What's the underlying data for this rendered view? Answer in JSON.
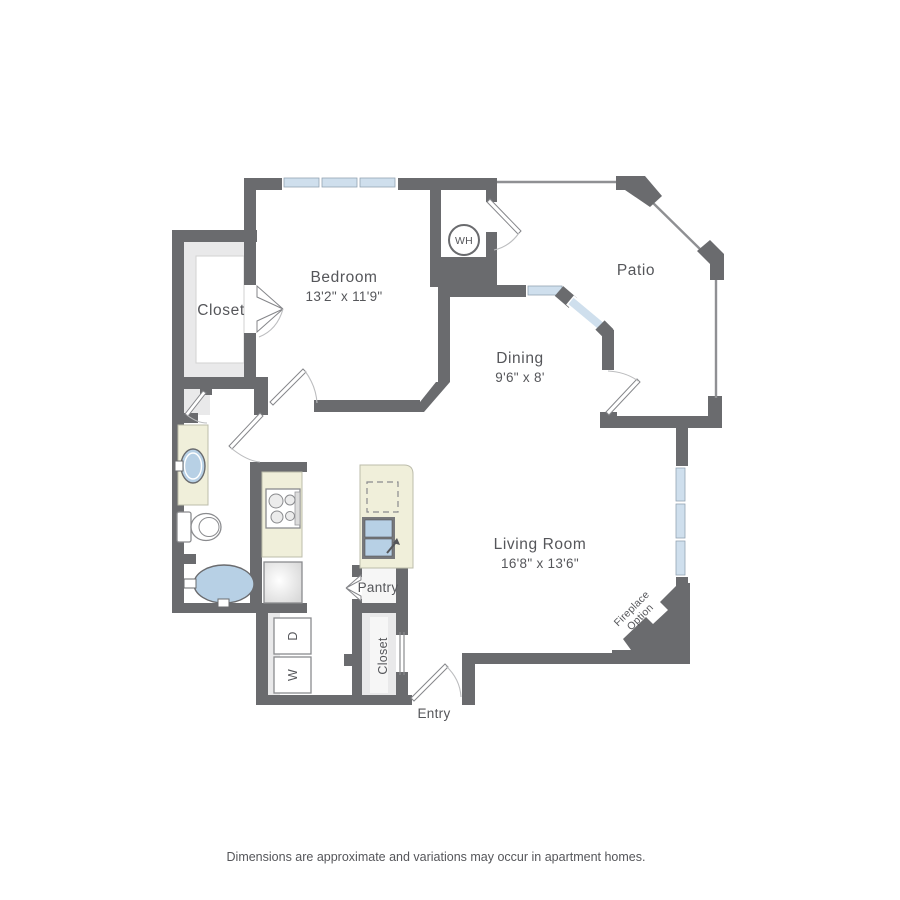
{
  "rooms": {
    "bedroom": {
      "label": "Bedroom",
      "dims": "13'2\" x 11'9\""
    },
    "bedroom_closet": {
      "label": "Closet"
    },
    "dining": {
      "label": "Dining",
      "dims": "9'6\" x 8'"
    },
    "patio": {
      "label": "Patio"
    },
    "living_room": {
      "label": "Living Room",
      "dims": "16'8\" x 13'6\""
    },
    "pantry": {
      "label": "Pantry"
    },
    "entry_closet": {
      "label": "Closet"
    },
    "entry": {
      "label": "Entry"
    },
    "water_heater": {
      "label": "WH"
    },
    "washer": {
      "label": "W"
    },
    "dryer": {
      "label": "D"
    },
    "fireplace": {
      "line1": "Fireplace",
      "line2": "Option"
    }
  },
  "disclaimer": "Dimensions are approximate and variations may occur in apartment homes.",
  "colors": {
    "wall": "#6a6b6e",
    "railing": "#8f9093",
    "window": "#cfdfed",
    "fixture": "#b7d0e5",
    "counter": "#f0efda",
    "interior": "#e9e9ea",
    "label": "#55565a"
  }
}
